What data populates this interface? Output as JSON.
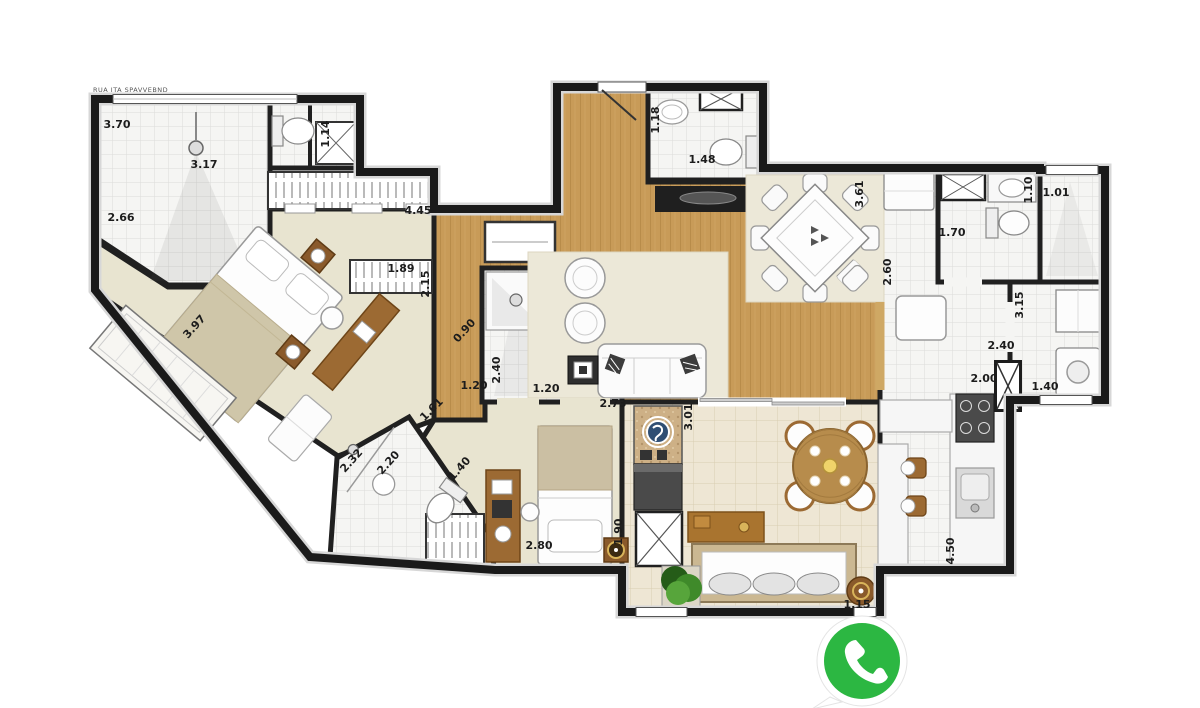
{
  "plan": {
    "header_note": "RUA ITA SPAVVEBND",
    "dimensions": [
      {
        "text": "3.70"
      },
      {
        "text": "3.17"
      },
      {
        "text": "2.66"
      },
      {
        "text": "1.14"
      },
      {
        "text": "4.45"
      },
      {
        "text": "1.89"
      },
      {
        "text": "2.15"
      },
      {
        "text": "3.97"
      },
      {
        "text": "0.90"
      },
      {
        "text": "2.40"
      },
      {
        "text": "1.20"
      },
      {
        "text": "2.73"
      },
      {
        "text": "1.18"
      },
      {
        "text": "1.48"
      },
      {
        "text": "3.61"
      },
      {
        "text": "2.60"
      },
      {
        "text": "1.70"
      },
      {
        "text": "1.10"
      },
      {
        "text": "1.01"
      },
      {
        "text": "3.15"
      },
      {
        "text": "2.40"
      },
      {
        "text": "2.00"
      },
      {
        "text": "1.40"
      },
      {
        "text": "4.50"
      },
      {
        "text": "3.01"
      },
      {
        "text": "1.90"
      },
      {
        "text": "2.80"
      },
      {
        "text": "1.20"
      },
      {
        "text": "1.61"
      },
      {
        "text": "2.20"
      },
      {
        "text": "1.40"
      },
      {
        "text": "2.32"
      },
      {
        "text": "1.15"
      }
    ],
    "colors": {
      "wall": "#202020",
      "wood": "#c89b58",
      "bedroom_floor": "#e8e4d0",
      "tile": "#f5f5f3",
      "balcony_tile": "#eee6d4",
      "whatsapp_green": "#2cb742"
    }
  }
}
